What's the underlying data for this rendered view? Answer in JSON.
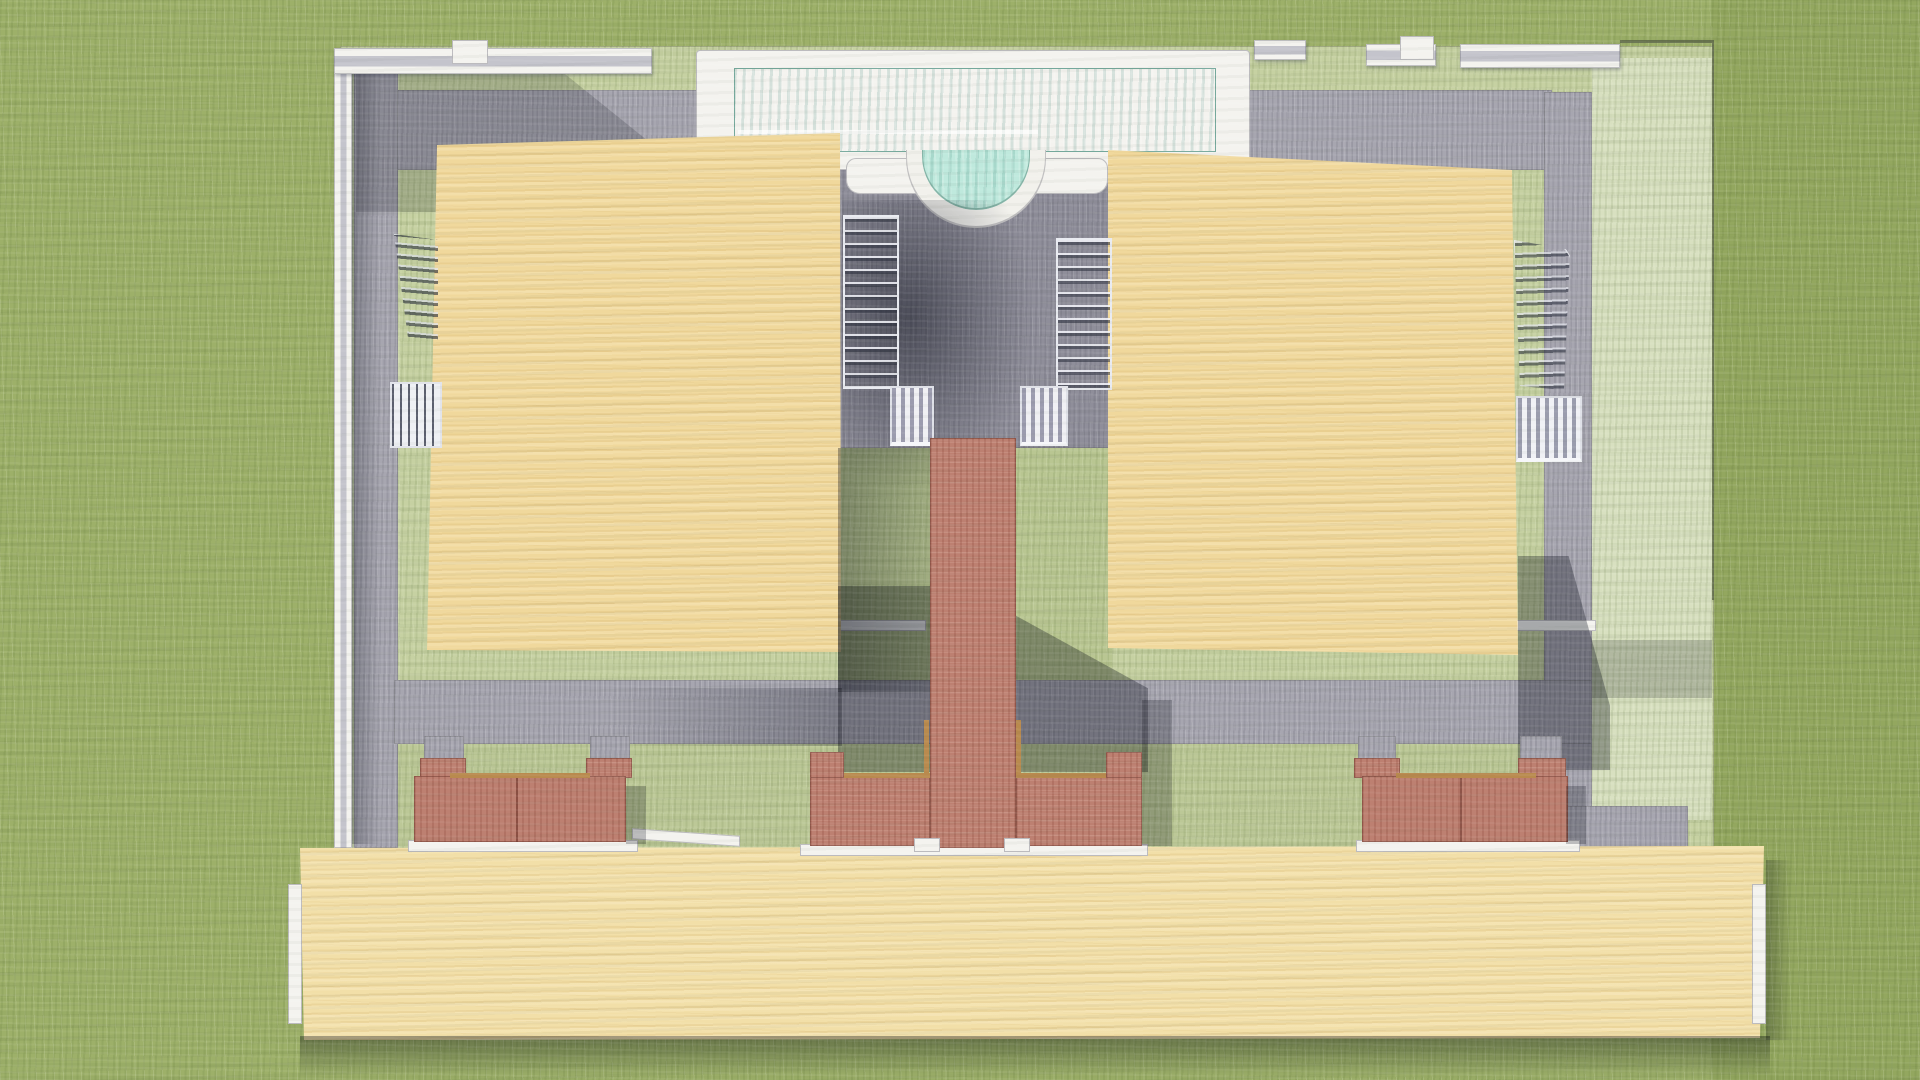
{
  "meta": {
    "title": "Architectural site plan rendering",
    "style": "colored-pencil sketch, top-down aerial view",
    "visible_text": "none"
  },
  "palette": {
    "grass_outer": "#9db069",
    "grass_outer_dark": "#93a75f",
    "grass_inner": "#c6d1a2",
    "grass_inner_light": "#d8e0c0",
    "grass_mid": "#b9c692",
    "grass_south": "#bcc897",
    "paving": "#a7a6b0",
    "paving_dark": "#7e7d8a",
    "courtyard": "#8f8e9a",
    "pool_deck": "#f2f1ec",
    "pool_water": "#8ed2c2",
    "pool_water_deep": "#5cb4a4",
    "pool_water_light": "#c4ebdf",
    "building_tan": "#f0d89c",
    "building_tan_light": "#f7e7ba",
    "building_grain": "#d9ba7a",
    "bottom_tan": "#f2dfa8",
    "brick": "#bd8071",
    "brick_dark": "#a2655a",
    "brick_light": "#d4a090",
    "wood_cap": "#b98a4e",
    "wall_white": "#f4f3ef",
    "wall_side": "#c4c4cc",
    "outline": "#5a5a52",
    "stair_dark": "#3f4452",
    "stair_light": "#b9bac6"
  },
  "scene": {
    "pool": {
      "position": "top center",
      "shape": "long rectangular lap pool with white deck and semicircular alcove bulging into courtyard on its south edge",
      "water_color": "#8ed2c2",
      "deck_color": "#f2f1ec",
      "detail": "underwater bench ledge visible on left half"
    },
    "buildings": [
      {
        "id": "left-villa",
        "position": "center-left",
        "roof_color": "#f0d89c",
        "shape": "large rectangle, slightly rotated, casts shadow to lower-right",
        "side_features": [
          "dark stairwell on west edge",
          "railed balcony on west edge"
        ]
      },
      {
        "id": "right-villa",
        "position": "center-right",
        "roof_color": "#f0d89c",
        "shape": "large rectangle, slightly rotated",
        "side_features": [
          "curved stairwell on east edge",
          "slatted balcony on east edge"
        ]
      },
      {
        "id": "long-south-building",
        "position": "bottom, nearly full width",
        "roof_color": "#f2dfa8",
        "shape": "long low rectangle with white end caps at both ends"
      }
    ],
    "courtyard": {
      "position": "between the two villas, below pool",
      "color": "#8f8e9a",
      "contains": [
        "left staircase with balcony",
        "right staircase with balcony",
        "pool alcove scallop",
        "large soft cast shadow"
      ]
    },
    "walkway": {
      "color": "#bd8071",
      "shape": "narrow brick path running south from courtyard, widening into T-shaped brick terrace wall with step blocks and white curb"
    },
    "planters": [
      {
        "id": "west-planter",
        "description": "brick planter wall with two capped pillars, west of center, above long building"
      },
      {
        "id": "center-terrace",
        "description": "wide T-shaped brick wall at center with wood cap rails and two small white steps"
      },
      {
        "id": "east-planter",
        "description": "brick planter wall with two capped pillars, east of center"
      }
    ],
    "landscape": {
      "outer_lawn": "#9db069",
      "inner_lawn": "#c6d1a2",
      "paths": "gray paved band around villas, along west and east sides, and horizontal path above planters"
    },
    "perimeter": "white-capped garden walls along north and west edges with two raised white piers; thin wall line on east boundary"
  }
}
